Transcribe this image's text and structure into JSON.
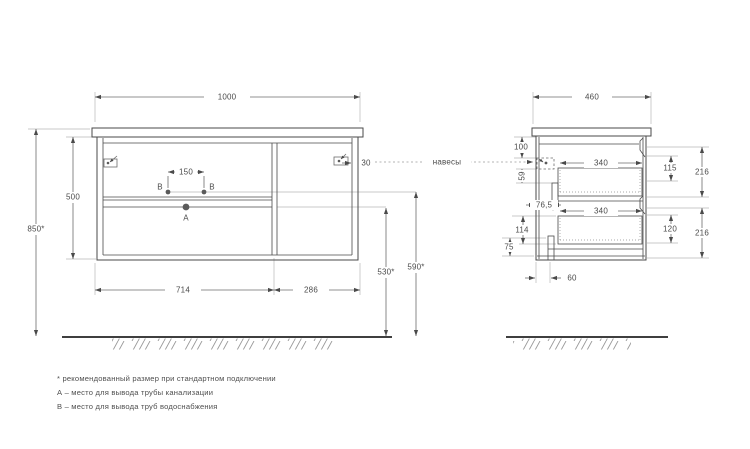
{
  "front": {
    "width": "1000",
    "height": "500",
    "total_height": "850*",
    "b_span": "150",
    "bracket_offset": "30",
    "left_section": "714",
    "right_section": "286",
    "drain_height": "530*",
    "supply_height": "590*",
    "label_a": "A",
    "label_b": "B"
  },
  "side": {
    "width": "460",
    "top_offset": "100",
    "bracket_gap": "59",
    "front_inset": "76,5",
    "drawer_depth": "340",
    "inner_upper": "115",
    "inner_lower": "120",
    "front_upper": "216",
    "front_lower": "216",
    "lower_inset": "114",
    "bottom_gap": "75",
    "recess": "60"
  },
  "labels": {
    "hangers": "навесы"
  },
  "footnotes": [
    "* рекомендованный размер при стандартном подключении",
    "А – место для вывода трубы канализации",
    "B – место для вывода труб водоснабжения"
  ]
}
